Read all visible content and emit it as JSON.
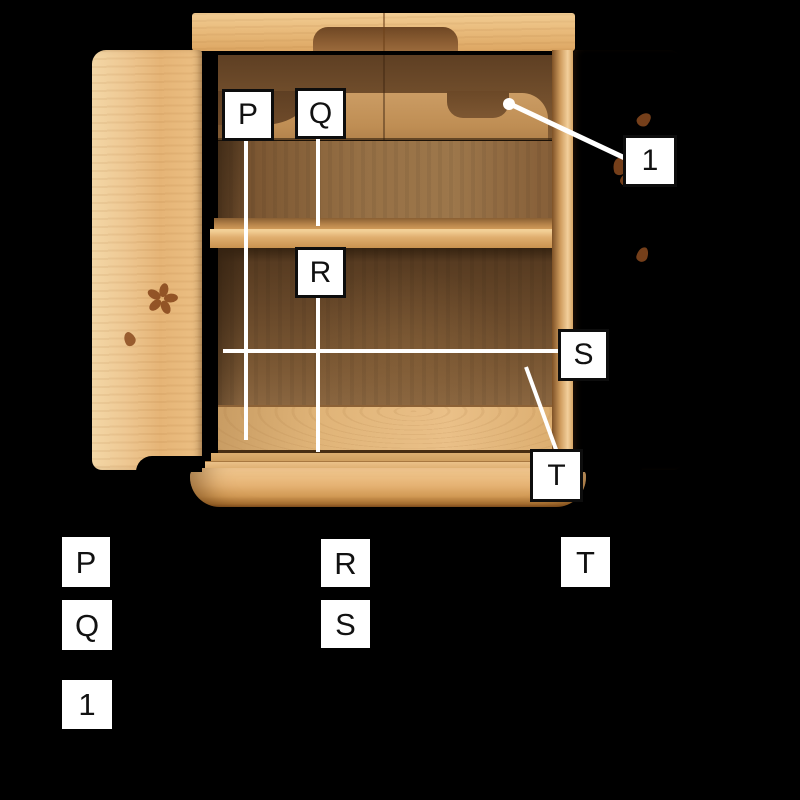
{
  "diagram": {
    "subject": "wooden cabinet with two open doors, one interior shelf, carved top valance and rounded base",
    "marker_labels": {
      "p": "P",
      "q": "Q",
      "r": "R",
      "s": "S",
      "t": "T",
      "n1": "1"
    },
    "measurement_lines": [
      {
        "id": "P",
        "type": "vertical",
        "x": 246,
        "y1": 140,
        "y2": 440
      },
      {
        "id": "Q",
        "type": "vertical",
        "x": 318,
        "y1": 138,
        "y2": 226
      },
      {
        "id": "R",
        "type": "vertical",
        "x": 318,
        "y1": 297,
        "y2": 452
      },
      {
        "id": "S",
        "type": "horizontal",
        "y": 351,
        "x1": 223,
        "x2": 558
      },
      {
        "id": "T",
        "type": "diagonal",
        "x1": 526,
        "y1": 367,
        "x2": 556,
        "y2": 449
      },
      {
        "id": "1",
        "type": "pointer",
        "dot_x": 509,
        "dot_y": 104,
        "x2": 626,
        "y2": 159
      }
    ]
  },
  "legend": {
    "column1": [
      "P",
      "Q",
      "1"
    ],
    "column2": [
      "R",
      "S"
    ],
    "column3": [
      "T"
    ]
  },
  "colors": {
    "background": "#000000",
    "line": "#ffffff",
    "label_box_bg": "#ffffff",
    "label_box_border": "#0d0d0d",
    "label_text": "#111111",
    "wood_light": "#eec287",
    "wood_frame": "#d9a660",
    "wood_interior_dark": "#5e3f23",
    "inlay": "#8a4a1e"
  }
}
